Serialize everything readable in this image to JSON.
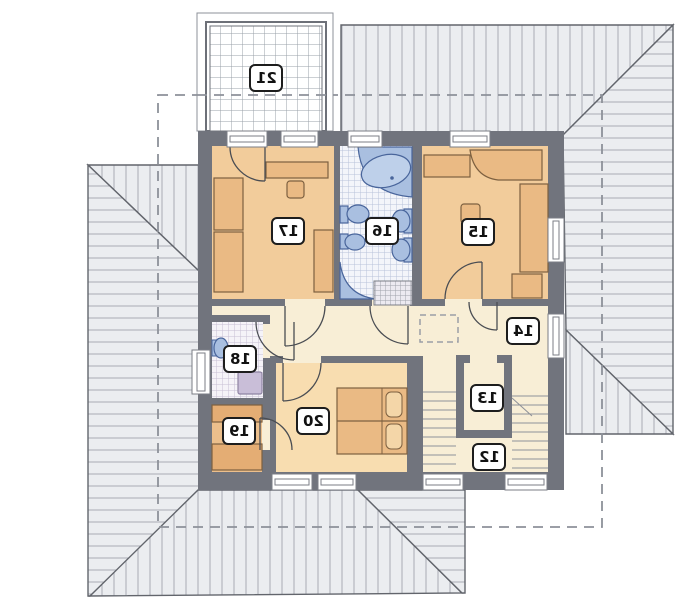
{
  "plan": {
    "kind": "upper-floor architectural plan (mirrored print)",
    "room_count": 10
  },
  "rooms": [
    {
      "id": "12",
      "label": "12",
      "area": "staircase"
    },
    {
      "id": "13",
      "label": "13",
      "area": "closet"
    },
    {
      "id": "14",
      "label": "14",
      "area": "hallway"
    },
    {
      "id": "15",
      "label": "15",
      "area": "bedroom"
    },
    {
      "id": "16",
      "label": "16",
      "area": "bathroom"
    },
    {
      "id": "17",
      "label": "17",
      "area": "bedroom"
    },
    {
      "id": "18",
      "label": "18",
      "area": "wc-laundry"
    },
    {
      "id": "19",
      "label": "19",
      "area": "wardrobe"
    },
    {
      "id": "20",
      "label": "20",
      "area": "bedroom"
    },
    {
      "id": "21",
      "label": "21",
      "area": "balcony"
    }
  ],
  "colors": {
    "wall": "#71747d",
    "roof_fill": "#ebedf0",
    "roof_hatch": "#a8acb4",
    "roof_edge": "#62656c",
    "bedroom_fill": "#f2cc9b",
    "furniture_fill": "#eaba84",
    "furniture_edge": "#7d6040",
    "room20_fill": "#f8ddb0",
    "room19_fill": "#ecbf8c",
    "cream_fill": "#f8eed6",
    "fixture_fill": "#a9bfe0",
    "fixture_edge": "#49659b",
    "washer_fill": "#c9bed8",
    "dashed_line": "#8d9199",
    "label_border": "#1d1d1d"
  }
}
